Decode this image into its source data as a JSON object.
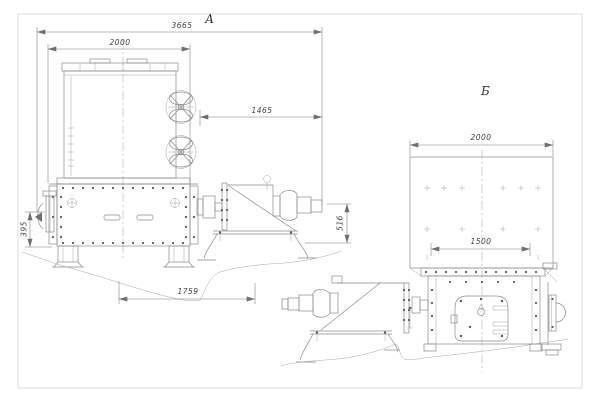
{
  "style": {
    "background": "#ffffff",
    "line_color": "#8a8a8a",
    "dim_line_color": "#787878",
    "text_color": "#3f3f3f",
    "border_color": "#dedede"
  },
  "view_a": {
    "label": "А",
    "dims": {
      "overall_width": "3665",
      "hopper_width": "2000",
      "drive_extension": "1465",
      "base_length": "1759",
      "left_height": "395",
      "drive_height": "516"
    }
  },
  "view_b": {
    "label": "Б",
    "dims": {
      "hopper_width": "2000",
      "base_width": "1500"
    }
  }
}
